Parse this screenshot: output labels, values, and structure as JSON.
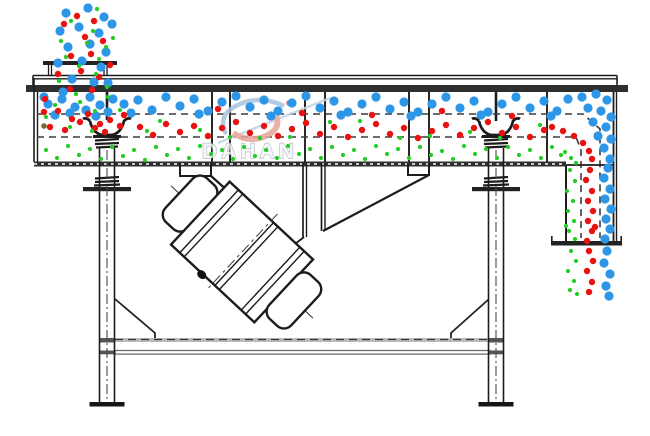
{
  "watermark": {
    "brand": "DAHAN"
  },
  "colors": {
    "blue": "#2e96e6",
    "red": "#ea1111",
    "green": "#23cd23",
    "dark": "#7a6a30",
    "line": "#1c1c1c",
    "deck_dash": "#3c3c3c",
    "beam_gray": "#9a9a9a",
    "watermark_stroke": "#aab2ba",
    "logo_red": "#e7a49b",
    "logo_blue": "#a9c2dd"
  },
  "particles": {
    "blue_r": 4.6,
    "red_r": 3.2,
    "green_r": 2.1,
    "dark_r": 2.8,
    "blue": [
      [
        66,
        13
      ],
      [
        88,
        8
      ],
      [
        104,
        17
      ],
      [
        60,
        31
      ],
      [
        79,
        27
      ],
      [
        99,
        33
      ],
      [
        112,
        24
      ],
      [
        68,
        47
      ],
      [
        90,
        44
      ],
      [
        106,
        52
      ],
      [
        58,
        63
      ],
      [
        82,
        61
      ],
      [
        101,
        67
      ],
      [
        72,
        79
      ],
      [
        94,
        82
      ],
      [
        63,
        92
      ],
      [
        108,
        83
      ],
      [
        48,
        104
      ],
      [
        62,
        99
      ],
      [
        75,
        107
      ],
      [
        90,
        97
      ],
      [
        55,
        115
      ],
      [
        70,
        113
      ],
      [
        86,
        110
      ],
      [
        100,
        105
      ],
      [
        113,
        99
      ],
      [
        44,
        97
      ],
      [
        108,
        112
      ],
      [
        124,
        104
      ],
      [
        96,
        116
      ],
      [
        138,
        100
      ],
      [
        152,
        110
      ],
      [
        166,
        97
      ],
      [
        180,
        106
      ],
      [
        194,
        99
      ],
      [
        208,
        111
      ],
      [
        222,
        102
      ],
      [
        236,
        96
      ],
      [
        250,
        107
      ],
      [
        264,
        100
      ],
      [
        278,
        111
      ],
      [
        292,
        103
      ],
      [
        306,
        96
      ],
      [
        320,
        108
      ],
      [
        334,
        101
      ],
      [
        348,
        112
      ],
      [
        362,
        104
      ],
      [
        376,
        97
      ],
      [
        390,
        109
      ],
      [
        404,
        102
      ],
      [
        418,
        112
      ],
      [
        432,
        104
      ],
      [
        446,
        97
      ],
      [
        460,
        108
      ],
      [
        474,
        101
      ],
      [
        488,
        112
      ],
      [
        502,
        104
      ],
      [
        516,
        97
      ],
      [
        530,
        108
      ],
      [
        544,
        101
      ],
      [
        557,
        111
      ],
      [
        568,
        99
      ],
      [
        131,
        113
      ],
      [
        199,
        114
      ],
      [
        271,
        116
      ],
      [
        341,
        115
      ],
      [
        411,
        116
      ],
      [
        481,
        115
      ],
      [
        551,
        116
      ],
      [
        582,
        97
      ],
      [
        596,
        94
      ],
      [
        607,
        100
      ],
      [
        588,
        108
      ],
      [
        601,
        111
      ],
      [
        611,
        117
      ],
      [
        593,
        122
      ],
      [
        606,
        127
      ],
      [
        611,
        139
      ],
      [
        604,
        148
      ],
      [
        610,
        159
      ],
      [
        598,
        136
      ],
      [
        608,
        168
      ],
      [
        604,
        178
      ],
      [
        610,
        189
      ],
      [
        605,
        199
      ],
      [
        611,
        209
      ],
      [
        606,
        219
      ],
      [
        610,
        229
      ],
      [
        605,
        239
      ],
      [
        607,
        251
      ],
      [
        604,
        263
      ],
      [
        610,
        274
      ],
      [
        606,
        286
      ],
      [
        609,
        296
      ]
    ],
    "red": [
      [
        77,
        16
      ],
      [
        94,
        21
      ],
      [
        64,
        24
      ],
      [
        85,
        37
      ],
      [
        103,
        41
      ],
      [
        71,
        56
      ],
      [
        91,
        54
      ],
      [
        58,
        74
      ],
      [
        81,
        71
      ],
      [
        99,
        77
      ],
      [
        70,
        89
      ],
      [
        92,
        90
      ],
      [
        110,
        65
      ],
      [
        45,
        99
      ],
      [
        58,
        111
      ],
      [
        72,
        119
      ],
      [
        88,
        114
      ],
      [
        100,
        124
      ],
      [
        50,
        127
      ],
      [
        65,
        130
      ],
      [
        80,
        122
      ],
      [
        95,
        128
      ],
      [
        110,
        120
      ],
      [
        120,
        126
      ],
      [
        44,
        112
      ],
      [
        105,
        132
      ],
      [
        124,
        115
      ],
      [
        140,
        127
      ],
      [
        153,
        135
      ],
      [
        166,
        124
      ],
      [
        180,
        132
      ],
      [
        194,
        126
      ],
      [
        208,
        136
      ],
      [
        222,
        128
      ],
      [
        236,
        122
      ],
      [
        250,
        133
      ],
      [
        264,
        126
      ],
      [
        278,
        136
      ],
      [
        292,
        129
      ],
      [
        306,
        123
      ],
      [
        320,
        134
      ],
      [
        334,
        127
      ],
      [
        348,
        137
      ],
      [
        362,
        130
      ],
      [
        376,
        124
      ],
      [
        390,
        134
      ],
      [
        404,
        128
      ],
      [
        418,
        138
      ],
      [
        432,
        131
      ],
      [
        446,
        125
      ],
      [
        460,
        135
      ],
      [
        474,
        128
      ],
      [
        488,
        122
      ],
      [
        502,
        133
      ],
      [
        516,
        127
      ],
      [
        530,
        137
      ],
      [
        544,
        130
      ],
      [
        302,
        113
      ],
      [
        372,
        115
      ],
      [
        442,
        111
      ],
      [
        512,
        116
      ],
      [
        218,
        109
      ],
      [
        552,
        127
      ],
      [
        563,
        131
      ],
      [
        574,
        136
      ],
      [
        583,
        143
      ],
      [
        589,
        151
      ],
      [
        592,
        159
      ],
      [
        590,
        170
      ],
      [
        586,
        180
      ],
      [
        592,
        191
      ],
      [
        588,
        201
      ],
      [
        593,
        211
      ],
      [
        588,
        221
      ],
      [
        592,
        231
      ],
      [
        587,
        241
      ],
      [
        595,
        227
      ],
      [
        589,
        251
      ],
      [
        593,
        261
      ],
      [
        587,
        271
      ],
      [
        592,
        282
      ],
      [
        589,
        292
      ]
    ],
    "green": [
      [
        97,
        9
      ],
      [
        71,
        21
      ],
      [
        93,
        31
      ],
      [
        61,
        41
      ],
      [
        87,
        43
      ],
      [
        106,
        47
      ],
      [
        66,
        57
      ],
      [
        99,
        59
      ],
      [
        79,
        66
      ],
      [
        59,
        81
      ],
      [
        96,
        74
      ],
      [
        107,
        87
      ],
      [
        76,
        94
      ],
      [
        113,
        38
      ],
      [
        55,
        105
      ],
      [
        80,
        102
      ],
      [
        95,
        111
      ],
      [
        46,
        117
      ],
      [
        70,
        127
      ],
      [
        92,
        131
      ],
      [
        108,
        97
      ],
      [
        120,
        110
      ],
      [
        147,
        131
      ],
      [
        200,
        130
      ],
      [
        260,
        138
      ],
      [
        330,
        122
      ],
      [
        400,
        138
      ],
      [
        470,
        132
      ],
      [
        540,
        125
      ],
      [
        290,
        137
      ],
      [
        360,
        121
      ],
      [
        430,
        136
      ],
      [
        500,
        138
      ],
      [
        230,
        137
      ],
      [
        160,
        121
      ],
      [
        46,
        150
      ],
      [
        57,
        158
      ],
      [
        68,
        146
      ],
      [
        79,
        155
      ],
      [
        90,
        149
      ],
      [
        101,
        159
      ],
      [
        112,
        147
      ],
      [
        123,
        156
      ],
      [
        134,
        150
      ],
      [
        145,
        160
      ],
      [
        156,
        147
      ],
      [
        167,
        155
      ],
      [
        178,
        149
      ],
      [
        189,
        158
      ],
      [
        200,
        146
      ],
      [
        211,
        154
      ],
      [
        222,
        150
      ],
      [
        233,
        159
      ],
      [
        244,
        147
      ],
      [
        255,
        156
      ],
      [
        266,
        150
      ],
      [
        277,
        158
      ],
      [
        288,
        146
      ],
      [
        299,
        154
      ],
      [
        310,
        149
      ],
      [
        321,
        158
      ],
      [
        332,
        147
      ],
      [
        343,
        155
      ],
      [
        354,
        150
      ],
      [
        365,
        159
      ],
      [
        376,
        146
      ],
      [
        387,
        154
      ],
      [
        398,
        149
      ],
      [
        409,
        158
      ],
      [
        420,
        147
      ],
      [
        431,
        155
      ],
      [
        442,
        151
      ],
      [
        453,
        159
      ],
      [
        464,
        146
      ],
      [
        475,
        154
      ],
      [
        486,
        149
      ],
      [
        497,
        158
      ],
      [
        508,
        147
      ],
      [
        519,
        155
      ],
      [
        530,
        150
      ],
      [
        541,
        158
      ],
      [
        552,
        147
      ],
      [
        561,
        155
      ],
      [
        565,
        152
      ],
      [
        571,
        158
      ],
      [
        576,
        163
      ],
      [
        570,
        170
      ],
      [
        575,
        181
      ],
      [
        567,
        191
      ],
      [
        573,
        201
      ],
      [
        568,
        211
      ],
      [
        574,
        221
      ],
      [
        569,
        231
      ],
      [
        575,
        239
      ],
      [
        566,
        226
      ],
      [
        571,
        251
      ],
      [
        576,
        261
      ],
      [
        568,
        271
      ],
      [
        574,
        281
      ],
      [
        570,
        290
      ],
      [
        577,
        294
      ]
    ],
    "dark": [
      [
        44,
        126
      ]
    ]
  }
}
